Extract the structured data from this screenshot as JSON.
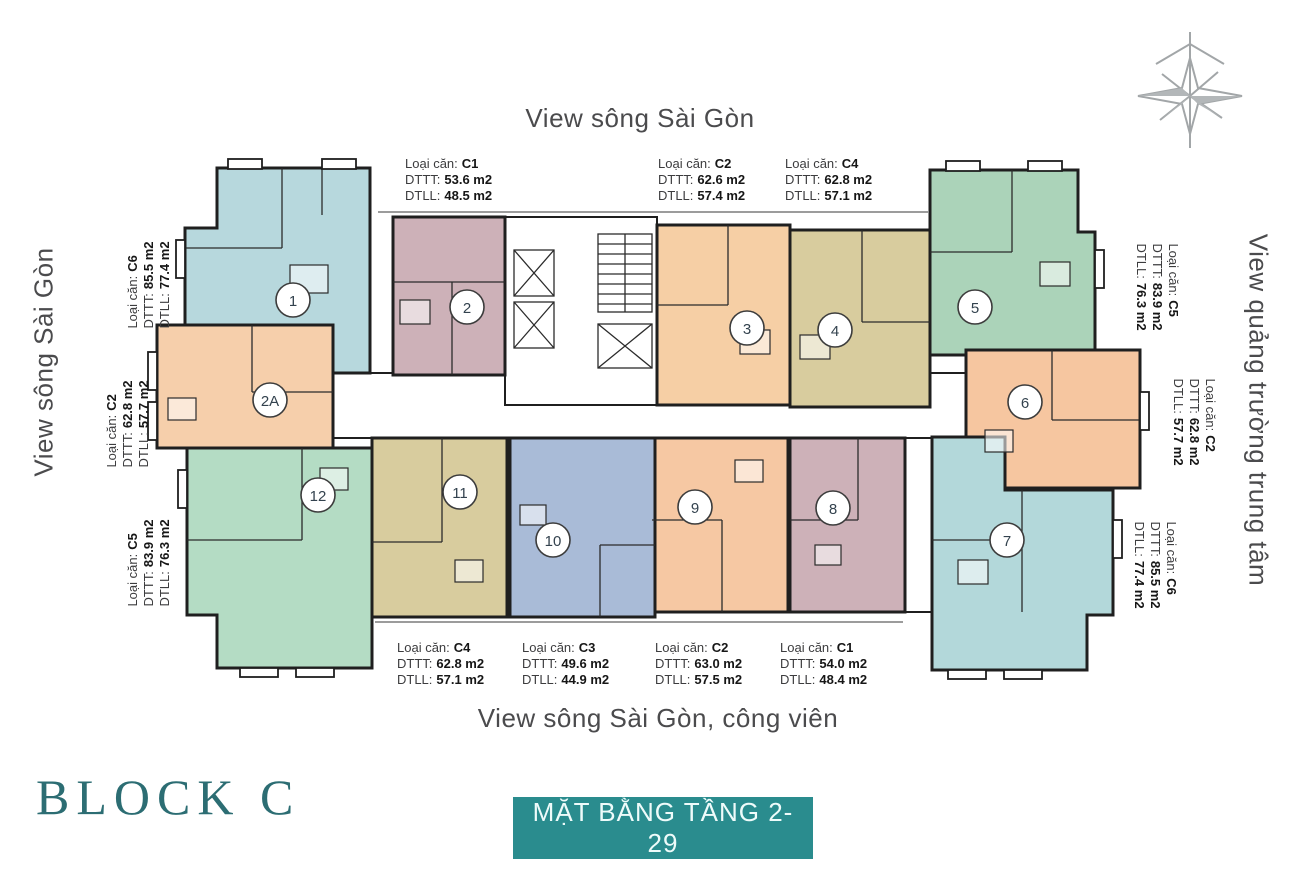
{
  "titles": {
    "top": "View sông Sài Gòn",
    "bottom": "View sông Sài Gòn, công viên",
    "left": "View sông Sài Gòn",
    "right": "View quảng trường trung tâm"
  },
  "block": {
    "title": "BLOCK C",
    "color": "#2c6d73"
  },
  "floor_button": {
    "label": "MẶT BẰNG TẦNG 2-29",
    "bg": "#2a8c8e"
  },
  "icons": {
    "compass": "compass-rose"
  },
  "specs": {
    "top": [
      {
        "type_label": "Loại căn:",
        "type": "C1",
        "dtt_label": "DTTT:",
        "dtt": "53.6 m2",
        "dtll_label": "DTLL:",
        "dtll": "48.5 m2"
      },
      {
        "type_label": "Loại căn:",
        "type": "C2",
        "dtt_label": "DTTT:",
        "dtt": "62.6 m2",
        "dtll_label": "DTLL:",
        "dtll": "57.4 m2"
      },
      {
        "type_label": "Loại căn:",
        "type": "C4",
        "dtt_label": "DTTT:",
        "dtt": "62.8 m2",
        "dtll_label": "DTLL:",
        "dtll": "57.1 m2"
      }
    ],
    "bottom": [
      {
        "type_label": "Loại căn:",
        "type": "C4",
        "dtt_label": "DTTT:",
        "dtt": "62.8 m2",
        "dtll_label": "DTLL:",
        "dtll": "57.1 m2"
      },
      {
        "type_label": "Loại căn:",
        "type": "C3",
        "dtt_label": "DTTT:",
        "dtt": "49.6 m2",
        "dtll_label": "DTLL:",
        "dtll": "44.9 m2"
      },
      {
        "type_label": "Loại căn:",
        "type": "C2",
        "dtt_label": "DTTT:",
        "dtt": "63.0 m2",
        "dtll_label": "DTLL:",
        "dtll": "57.5 m2"
      },
      {
        "type_label": "Loại căn:",
        "type": "C1",
        "dtt_label": "DTTT:",
        "dtt": "54.0 m2",
        "dtll_label": "DTLL:",
        "dtll": "48.4 m2"
      }
    ],
    "left": [
      {
        "type_label": "Loại căn:",
        "type": "C6",
        "dtt_label": "DTTT:",
        "dtt": "85.5 m2",
        "dtll_label": "DTLL:",
        "dtll": "77.4 m2"
      },
      {
        "type_label": "Loại căn:",
        "type": "C2",
        "dtt_label": "DTTT:",
        "dtt": "62.8 m2",
        "dtll_label": "DTLL:",
        "dtll": "57.7 m2"
      },
      {
        "type_label": "Loại căn:",
        "type": "C5",
        "dtt_label": "DTTT:",
        "dtt": "83.9 m2",
        "dtll_label": "DTLL:",
        "dtll": "76.3 m2"
      }
    ],
    "right": [
      {
        "type_label": "Loại căn:",
        "type": "C5",
        "dtt_label": "DTTT:",
        "dtt": "83.9 m2",
        "dtll_label": "DTLL:",
        "dtll": "76.3 m2"
      },
      {
        "type_label": "Loại căn:",
        "type": "C2",
        "dtt_label": "DTTT:",
        "dtt": "62.8 m2",
        "dtll_label": "DTLL:",
        "dtll": "57.7 m2"
      },
      {
        "type_label": "Loại căn:",
        "type": "C6",
        "dtt_label": "DTTT:",
        "dtt": "85.5 m2",
        "dtll_label": "DTLL:",
        "dtll": "77.4 m2"
      }
    ]
  },
  "units": [
    {
      "number": "1",
      "color": "#b7d8dd"
    },
    {
      "number": "2",
      "color": "#cdb1b8"
    },
    {
      "number": "2A",
      "color": "#f6cfab"
    },
    {
      "number": "3",
      "color": "#f6cfa5"
    },
    {
      "number": "4",
      "color": "#d8cc9e"
    },
    {
      "number": "5",
      "color": "#abd3b9"
    },
    {
      "number": "6",
      "color": "#f6c6a0"
    },
    {
      "number": "7",
      "color": "#b3d8da"
    },
    {
      "number": "8",
      "color": "#cdb1b8"
    },
    {
      "number": "9",
      "color": "#f6c8a3"
    },
    {
      "number": "10",
      "color": "#a9bbd7"
    },
    {
      "number": "11",
      "color": "#d8cc9e"
    },
    {
      "number": "12",
      "color": "#b4dcc4"
    }
  ]
}
